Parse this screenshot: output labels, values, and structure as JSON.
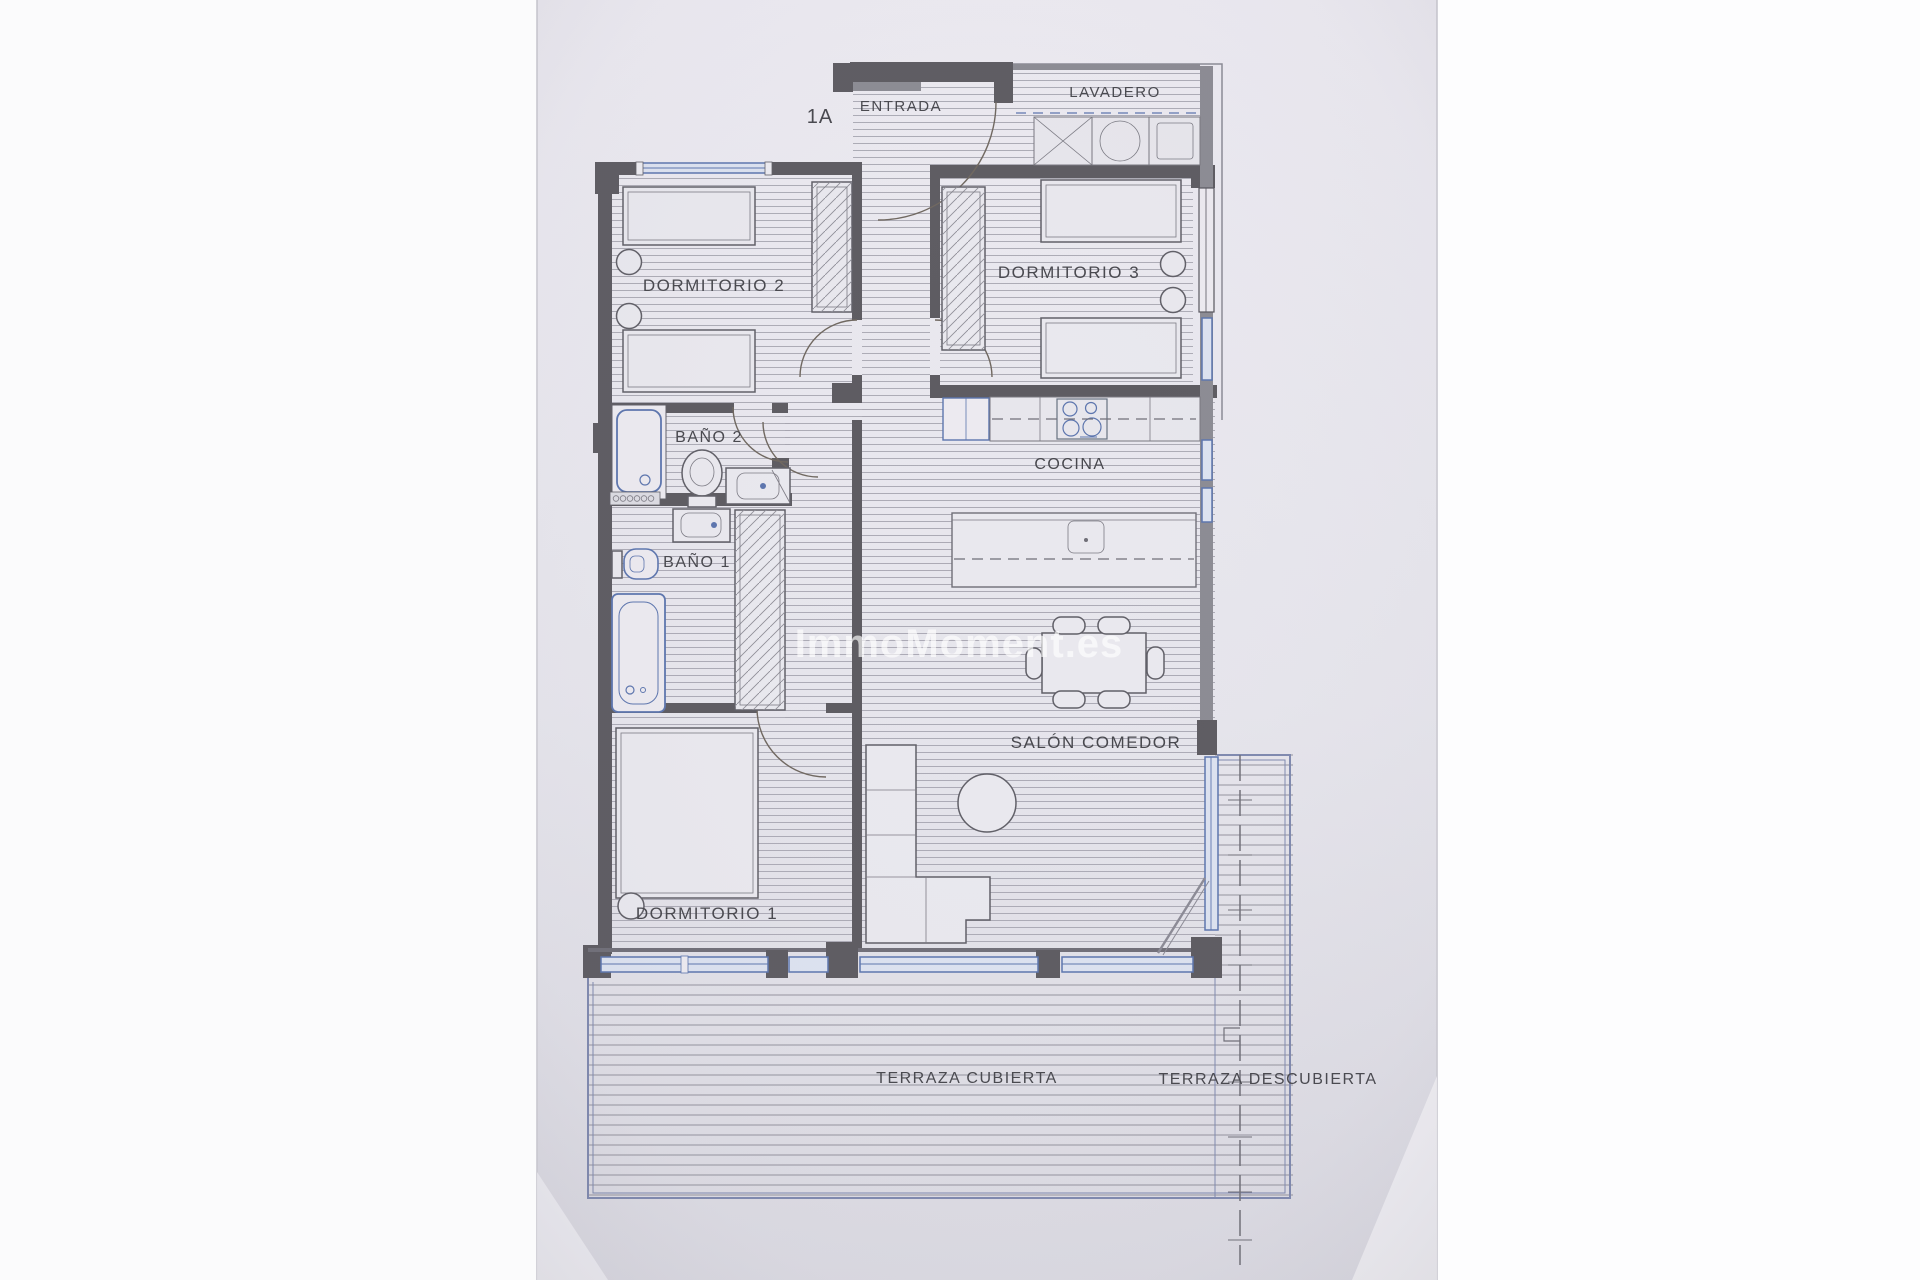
{
  "unit_label": "1A",
  "watermark": "ImmoMoment.es",
  "rooms": {
    "entrada": "ENTRADA",
    "lavadero": "LAVADERO",
    "dormitorio2": "DORMITORIO 2",
    "dormitorio3": "DORMITORIO 3",
    "bano2": "BAÑO 2",
    "bano1": "BAÑO 1",
    "cocina": "COCINA",
    "salon_comedor": "SALÓN COMEDOR",
    "dormitorio1": "DORMITORIO 1",
    "terraza_cubierta": "TERRAZA CUBIERTA",
    "terraza_descubierta": "TERRAZA DESCUBIERTA"
  },
  "colors": {
    "paper": "#e8e7ed",
    "margin": "#fdfdfe",
    "wall_dark": "#5c5a60",
    "wall_medium": "#8b8a92",
    "hatch_line": "#a5a4af",
    "accent_blue": "#5b74ad",
    "label_text": "#46464c",
    "watermark_white": "rgba(255,255,255,0.65)"
  }
}
